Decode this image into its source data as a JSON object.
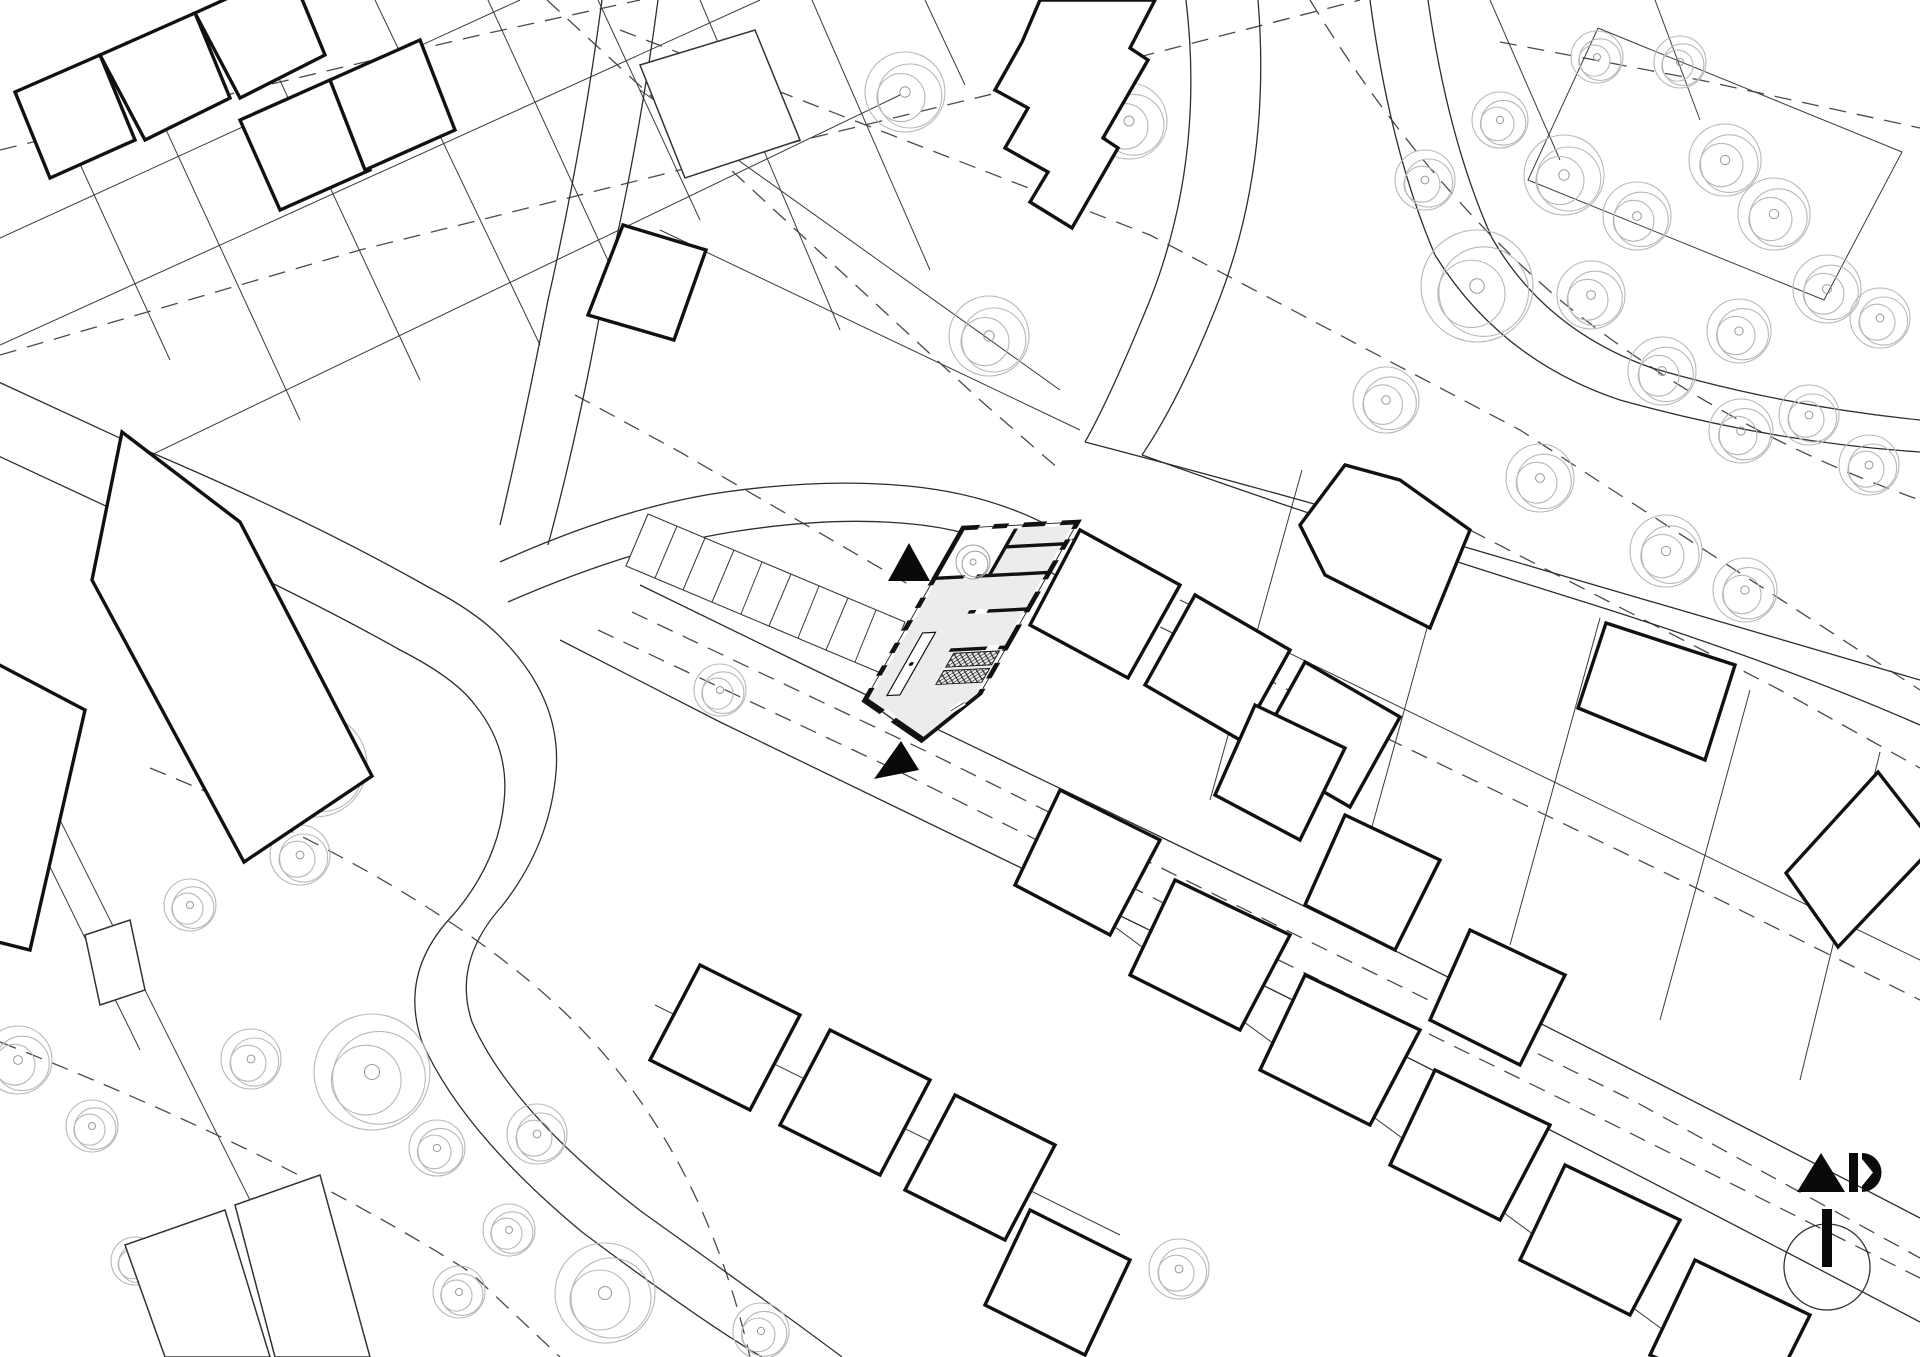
{
  "canvas": {
    "width": 1920,
    "height": 1357,
    "background": "#ffffff"
  },
  "colors": {
    "ink": "#111111",
    "parcel_line": "#3a3a3a",
    "road_line": "#2e2e2e",
    "dashed_line": "#4a4a4a",
    "tree_line": "#b8b8b8",
    "room_fill": "#ececec",
    "paper": "#ffffff",
    "marker_fill": "#0a0a0a"
  },
  "map": {
    "parcel_lines": [
      "0,238 520,0",
      "0,345 760,0",
      "120,470 900,95",
      "150,95 300,420",
      "262,42 420,380",
      "375,0 540,345",
      "488,0 640,330",
      "598,0 700,220",
      "56,112 170,360",
      "700,0 840,330",
      "812,0 930,270",
      "640,90 1060,390",
      "660,230 1080,430",
      "925,0 965,85",
      "1490,0 1560,160",
      "1655,0 1700,120",
      "1598,28 1902,152 1824,300 1528,180 1598,28",
      "1180,600 1920,960",
      "1302,470 1210,800",
      "1450,545 1360,870",
      "1600,618 1510,945",
      "1750,690 1660,1020",
      "1880,752 1800,1080",
      "1085,905 1700,1357",
      "655,1005 1120,1235",
      "60,820 300,1300",
      "0,765 140,1050"
    ],
    "roads": [
      "M-10,378 L150,452 Q310,520 430,588 Q480,614 505,642",
      "M-10,452 L140,522 Q290,588 400,650 Q455,678 475,705",
      "M505,642 Q562,702 556,772 Q550,845 502,906 Q452,962 472,1022 Q512,1112 642,1212 Q782,1312 842,1357",
      "M475,705 Q510,748 504,802 Q498,862 454,914 Q398,972 422,1042 Q462,1132 582,1232 Q702,1322 762,1357",
      "M602,0 Q582,150 548,300 Q522,432 500,525",
      "M658,0 Q638,152 602,302 Q578,434 548,545",
      "M500,562 Q625,506 725,492 Q825,478 908,486 Q1012,496 1085,548",
      "M508,602 Q632,548 732,532 Q832,516 912,524 Q998,532 1062,580",
      "M1186,0 Q1205,160 1150,300 Q1110,398 1085,442",
      "M1258,0 Q1272,170 1215,310 Q1178,402 1142,455",
      "M1085,442 Q1300,498 1550,572 Q1762,634 1920,680",
      "M1142,455 Q1322,520 1562,595 Q1772,660 1920,725",
      "M1370,0 Q1390,150 1435,255 Q1500,360 1620,400 Q1770,442 1920,452",
      "M1428,0 Q1448,140 1492,238 Q1545,330 1652,368 Q1782,406 1920,420",
      "M640,585 L800,663 Q1000,760 1250,880 Q1500,1000 1920,1218",
      "M560,640 L720,722 Q920,820 1170,940 Q1430,1065 1920,1322"
    ],
    "dashed_polylines": [
      "547,0 980,400 1060,470",
      "620,30 1150,235 1520,430 1920,690",
      "0,355 360,250 700,165 1050,80 1360,0",
      "0,150 280,82 480,35 640,0",
      "598,630 900,772 1250,946 1600,1118 1920,1278",
      "632,612 934,755 1284,929 1634,1101 1920,1258",
      "1085,590 1380,735 1680,880 1920,1000",
      "1500,42 1700,80 1920,128",
      "1470,530 1780,690 1920,768",
      "575,395 680,452 913,587"
    ],
    "dashed_paths": [
      "M150,768 Q420,878 560,1008 Q700,1140 750,1357",
      "M0,1042 Q280,1152 470,1272 L560,1357",
      "M1310,0 Q1420,180 1560,300 Q1720,430 1920,500"
    ],
    "thin_buildings": [
      "125,1245 225,1210 270,1357 165,1357",
      "235,1205 320,1175 370,1357 275,1357",
      "85,935 130,920 145,990 100,1005",
      "640,65 755,30 800,140 685,178"
    ],
    "buildings": [
      "15,92 100,55 135,140 50,178",
      "100,55 195,13 230,98 145,140",
      "195,13 290,-30 325,55 240,98",
      "240,120 330,80 370,170 280,210",
      "330,80 420,40 455,130 365,170",
      "623,225 706,250 674,340 588,315",
      "1040,0 1155,0 1130,48 1148,60 1103,138 1118,148 1072,228 1030,202 1048,172 1005,148 1028,108 995,90 1022,42",
      "122,432 240,522 372,776 244,862 92,580",
      "-10,660 85,710 30,950 -10,940",
      "1080,530 1180,585 1128,678 1030,625",
      "1195,595 1290,650 1240,740 1145,685",
      "1305,662 1400,717 1350,807 1255,752",
      "1300,525 1345,465 1400,480 1470,530 1430,628 1325,575",
      "1606,623 1735,665 1705,760 1578,708",
      "1878,772 1935,845 1838,947 1786,873",
      "1255,705 1345,748 1300,840 1215,795",
      "1345,815 1440,860 1395,950 1305,905",
      "1470,930 1565,975 1520,1065 1430,1020",
      "1060,790 1160,840 1110,935 1015,885",
      "1175,880 1290,935 1240,1030 1130,975",
      "1305,975 1420,1030 1370,1125 1260,1070",
      "1435,1070 1550,1125 1500,1220 1390,1165",
      "1565,1165 1680,1220 1630,1315 1520,1260",
      "1695,1260 1810,1315 1765,1405 1650,1355",
      "700,965 800,1015 750,1110 650,1060",
      "830,1030 930,1080 880,1175 780,1125",
      "955,1095 1055,1145 1005,1240 905,1190",
      "1030,1210 1130,1260 1085,1355 985,1305"
    ],
    "trees": [
      {
        "x": 905,
        "y": 92,
        "r": 40
      },
      {
        "x": 1129,
        "y": 121,
        "r": 38
      },
      {
        "x": 989,
        "y": 336,
        "r": 40
      },
      {
        "x": 1386,
        "y": 400,
        "r": 33
      },
      {
        "x": 1564,
        "y": 175,
        "r": 40
      },
      {
        "x": 1637,
        "y": 216,
        "r": 34
      },
      {
        "x": 1591,
        "y": 295,
        "r": 34
      },
      {
        "x": 1725,
        "y": 160,
        "r": 36
      },
      {
        "x": 1774,
        "y": 214,
        "r": 36
      },
      {
        "x": 1827,
        "y": 289,
        "r": 34
      },
      {
        "x": 1880,
        "y": 318,
        "r": 30
      },
      {
        "x": 1739,
        "y": 331,
        "r": 32
      },
      {
        "x": 1662,
        "y": 371,
        "r": 34
      },
      {
        "x": 1741,
        "y": 431,
        "r": 32
      },
      {
        "x": 1809,
        "y": 415,
        "r": 30
      },
      {
        "x": 1869,
        "y": 465,
        "r": 30
      },
      {
        "x": 1477,
        "y": 286,
        "r": 56
      },
      {
        "x": 1425,
        "y": 180,
        "r": 30
      },
      {
        "x": 1500,
        "y": 120,
        "r": 28
      },
      {
        "x": 1680,
        "y": 62,
        "r": 26
      },
      {
        "x": 1597,
        "y": 57,
        "r": 26
      },
      {
        "x": 1540,
        "y": 478,
        "r": 34
      },
      {
        "x": 1666,
        "y": 551,
        "r": 36
      },
      {
        "x": 1745,
        "y": 590,
        "r": 32
      },
      {
        "x": 315,
        "y": 765,
        "r": 52
      },
      {
        "x": 300,
        "y": 855,
        "r": 30
      },
      {
        "x": 250,
        "y": 700,
        "r": 30
      },
      {
        "x": 190,
        "y": 905,
        "r": 26
      },
      {
        "x": 720,
        "y": 690,
        "r": 26
      },
      {
        "x": 92,
        "y": 1126,
        "r": 26
      },
      {
        "x": 251,
        "y": 1059,
        "r": 30
      },
      {
        "x": 372,
        "y": 1072,
        "r": 58
      },
      {
        "x": 437,
        "y": 1148,
        "r": 28
      },
      {
        "x": 537,
        "y": 1134,
        "r": 30
      },
      {
        "x": 509,
        "y": 1230,
        "r": 26
      },
      {
        "x": 459,
        "y": 1292,
        "r": 26
      },
      {
        "x": 605,
        "y": 1293,
        "r": 50
      },
      {
        "x": 761,
        "y": 1331,
        "r": 28
      },
      {
        "x": 135,
        "y": 1261,
        "r": 24
      },
      {
        "x": 18,
        "y": 1060,
        "r": 34
      },
      {
        "x": 1179,
        "y": 1269,
        "r": 30
      }
    ],
    "parking": {
      "outline": "648,514 905,622 883,674 626,566",
      "stalls": [
        [
          677,
          526,
          655,
          578
        ],
        [
          705,
          538,
          683,
          590
        ],
        [
          734,
          550,
          712,
          602
        ],
        [
          762,
          562,
          741,
          614
        ],
        [
          791,
          574,
          769,
          626
        ],
        [
          819,
          586,
          798,
          638
        ],
        [
          848,
          598,
          826,
          650
        ],
        [
          876,
          610,
          855,
          662
        ]
      ]
    },
    "site": {
      "matrix": [
        0.9986,
        -0.0521,
        -0.4952,
        0.8691,
        963,
        528
      ],
      "footprint": "0,0 115,0 115,198 83,249 0,198",
      "courtyard": {
        "x": 3,
        "y": 3,
        "w": 50,
        "h": 54
      },
      "partitions": [
        {
          "x1": 55,
          "y1": 3,
          "x2": 55,
          "y2": 58
        },
        {
          "x1": 0,
          "y1": 58,
          "x2": 115,
          "y2": 58
        },
        {
          "x1": 55,
          "y1": 25,
          "x2": 115,
          "y2": 25
        },
        {
          "x1": 55,
          "y1": 100,
          "x2": 115,
          "y2": 100
        },
        {
          "x1": 58,
          "y1": 144,
          "x2": 115,
          "y2": 144
        }
      ],
      "door_gaps": [
        {
          "x1": 30,
          "y1": 58,
          "x2": 42,
          "y2": 58
        },
        {
          "x1": 62,
          "y1": 100,
          "x2": 74,
          "y2": 100
        },
        {
          "x1": 95,
          "y1": 144,
          "x2": 107,
          "y2": 144
        }
      ],
      "stairs": [
        {
          "x": 64,
          "y": 148,
          "w": 46,
          "h": 16
        },
        {
          "x": 64,
          "y": 168,
          "w": 46,
          "h": 16
        }
      ],
      "table": {
        "x": 20,
        "y": 122,
        "w": 13,
        "h": 72,
        "dot": {
          "x": 26.5,
          "y": 158,
          "r": 2.2
        }
      },
      "windows": [
        {
          "x1": 0,
          "y1": 66,
          "x2": 0,
          "y2": 80
        },
        {
          "x1": 0,
          "y1": 92,
          "x2": 0,
          "y2": 106
        },
        {
          "x1": 0,
          "y1": 118,
          "x2": 0,
          "y2": 132
        },
        {
          "x1": 0,
          "y1": 144,
          "x2": 0,
          "y2": 158
        },
        {
          "x1": 0,
          "y1": 170,
          "x2": 0,
          "y2": 184
        },
        {
          "x1": 16,
          "y1": 0,
          "x2": 30,
          "y2": 0
        },
        {
          "x1": 45,
          "y1": 0,
          "x2": 60,
          "y2": 0
        },
        {
          "x1": 83,
          "y1": 0,
          "x2": 98,
          "y2": 0
        },
        {
          "x1": 115,
          "y1": 8,
          "x2": 115,
          "y2": 20
        },
        {
          "x1": 115,
          "y1": 32,
          "x2": 115,
          "y2": 44
        },
        {
          "x1": 115,
          "y1": 66,
          "x2": 115,
          "y2": 80
        },
        {
          "x1": 115,
          "y1": 104,
          "x2": 115,
          "y2": 118
        },
        {
          "x1": 115,
          "y1": 148,
          "x2": 115,
          "y2": 162
        },
        {
          "x1": 115,
          "y1": 180,
          "x2": 115,
          "y2": 192
        },
        {
          "x1": 25,
          "y1": 213,
          "x2": 41,
          "y2": 223
        },
        {
          "x1": 95,
          "y1": 216,
          "x2": 104,
          "y2": 207
        }
      ],
      "courtyard_tree": {
        "x": 973,
        "y": 562,
        "r": 17
      }
    },
    "entrance_markers": [
      {
        "points": "888,581 930,581 909,543"
      },
      {
        "points": "874,779 919,770 901,741"
      }
    ],
    "logo": {
      "triangle": "1797,1192 1845,1192 1821,1153",
      "bar": {
        "x": 1849,
        "y": 1153,
        "w": 9,
        "h": 39
      },
      "dshape": "M1862,1153 A19.5,19.5 0 1 1 1862,1192 L1862,1186 L1873,1172.5 L1862,1159 Z"
    },
    "compass": {
      "cx": 1827,
      "cy": 1267,
      "r": 43,
      "bar": {
        "x": 1822,
        "y": 1209,
        "w": 10,
        "h": 58
      }
    }
  }
}
